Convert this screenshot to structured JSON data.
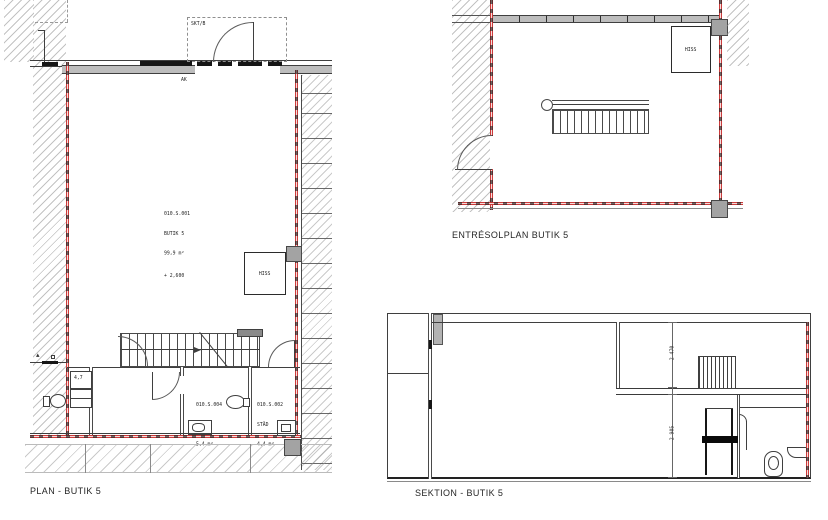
{
  "plan": {
    "caption": "PLAN - BUTIK 5",
    "canopy_label": "SKT/B",
    "note_ak": "AK",
    "room_main": {
      "id": "010.S.001",
      "name": "BUTIK 5",
      "area": "99,9 m²",
      "level": "+ 2,600"
    },
    "room_rwc": {
      "id": "010.S.004",
      "name": "RWC/D",
      "area": "5,4 m²"
    },
    "room_stad": {
      "id": "010.S.002",
      "name": "STÄD",
      "area": "4,4 m²"
    },
    "shaft_label": "4,7",
    "elevator_label": "HISS"
  },
  "entresol": {
    "caption": "ENTRÉSOLPLAN BUTIK 5",
    "elevator_label": "HISS"
  },
  "section": {
    "caption": "SEKTION - BUTIK 5",
    "dim_upper": "2 470",
    "dim_lower": "2 905"
  },
  "colors": {
    "wall_red": "#cc3b3b",
    "line_dark": "#3f3f3f",
    "hatch_gray": "#919191",
    "wall_gray": "#bdbdbd"
  }
}
